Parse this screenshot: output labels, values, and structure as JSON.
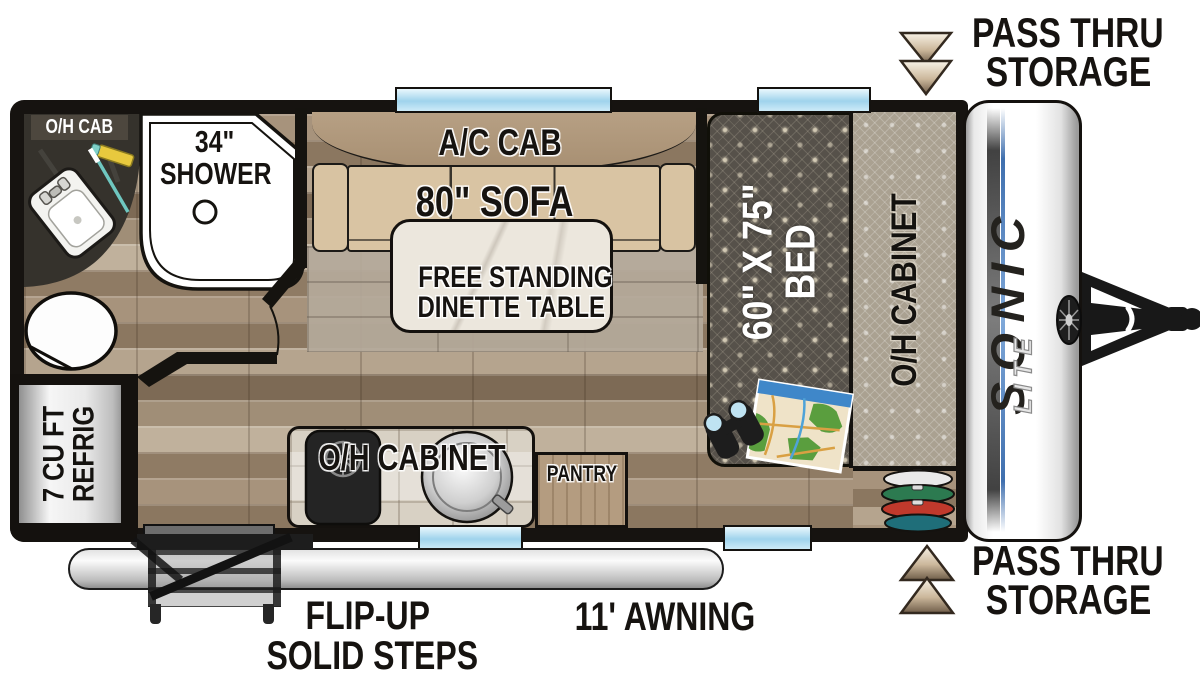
{
  "floorplan": {
    "labels": {
      "oh_cab": "O/H CAB",
      "shower_size": "34\"",
      "shower": "SHOWER",
      "ac_cab": "A/C CAB",
      "sofa": "80\" SOFA",
      "dinette_line1": "FREE STANDING",
      "dinette_line2": "DINETTE TABLE",
      "bed_size": "60\" X 75\"",
      "bed": "BED",
      "oh_cabinet_right": "O/H CABINET",
      "refrig_line1": "7 CU FT",
      "refrig_line2": "REFRIG",
      "oh_cabinet_kitchen": "O/H CABINET",
      "pantry": "PANTRY"
    },
    "exterior": {
      "pass_thru_top_line1": "PASS THRU",
      "pass_thru_top_line2": "STORAGE",
      "pass_thru_bottom_line1": "PASS THRU",
      "pass_thru_bottom_line2": "STORAGE",
      "steps_line1": "FLIP-UP",
      "steps_line2": "SOLID STEPS",
      "awning": "11' AWNING",
      "brand_name": "SONIC",
      "brand_sub": "LITE"
    },
    "colors": {
      "wall": "#161310",
      "window_blue": "#9fd3ec",
      "sofa_tan": "#d9c4a3",
      "bed_dark": "#56514a",
      "cabinet_taupe": "#aaa191",
      "arrow_tan": "#cbb79b",
      "brand_stripe_blue": "#3f6fae",
      "wood_floor": "#9a8670"
    }
  }
}
